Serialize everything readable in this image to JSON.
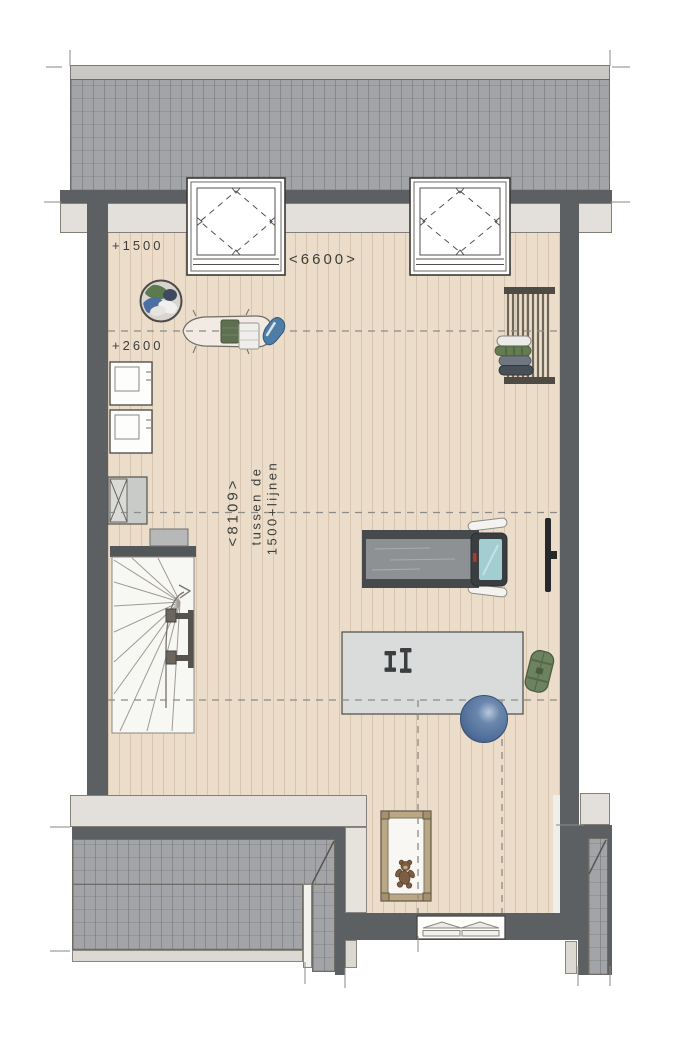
{
  "plan": {
    "labels": {
      "level_front": "+1500",
      "level_back": "+2600",
      "width_dim": "<6600>",
      "depth_dim": "<8109>",
      "between_text_1": "tussen de",
      "between_text_2": "1500+lijnen"
    },
    "colors": {
      "wall": "#5d6063",
      "roof_tile": "#a2a4a7",
      "eaves": "#e3dfda",
      "floor": "#ebddca",
      "exercise_ball": "#57749d",
      "sports_bag": "#6d8360",
      "treadmill_screen": "#a3ced1",
      "text": "#3e3d3a"
    },
    "items": [
      "pitched-roof",
      "skylight-left",
      "skylight-right",
      "laundry-basket",
      "ironing-board",
      "washing-machine-top",
      "washing-machine-bottom",
      "ventilation-unit",
      "storage-box",
      "staircase",
      "clothes-drying-rack",
      "wall-tv",
      "treadmill",
      "fitness-mat",
      "dumbbells",
      "exercise-ball",
      "sports-bag",
      "crib-with-teddy",
      "facade-window",
      "lower-roof-left",
      "lower-roof-right"
    ]
  }
}
